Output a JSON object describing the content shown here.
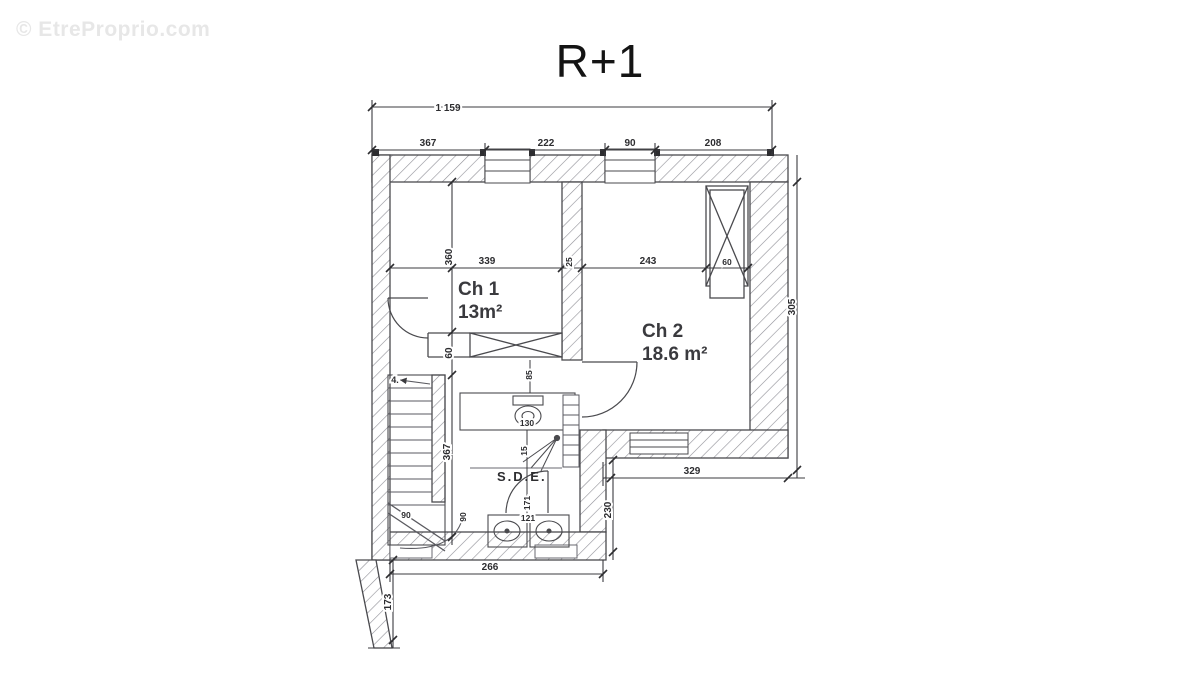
{
  "watermark": "© EtreProprio.com",
  "title": "R+1",
  "rooms": {
    "ch1_name": "Ch 1",
    "ch1_area": "13m²",
    "ch2_name": "Ch 2",
    "ch2_area": "18.6 m²",
    "sde_name": "S.D.E."
  },
  "stairs": {
    "count_label": "4."
  },
  "dims": {
    "total_width": "1 159",
    "top_seg_left": "367",
    "top_seg_win1": "222",
    "top_seg_win2": "90",
    "top_seg_right": "208",
    "ch1_width": "339",
    "wall_thickness": "25",
    "ch2_width": "243",
    "duct_width": "60",
    "ch1_depth": "360",
    "hall_height": "60",
    "stair_height": "367",
    "stair_width": "90",
    "hall_width": "90",
    "right_height": "305",
    "ch2_bottom_width": "329",
    "sde_right_height": "230",
    "bottom_width": "266",
    "left_ext_height": "173",
    "wc_width": "130",
    "wc_side": "85",
    "shower_dim": "15",
    "sde_door_dim": "171",
    "sde_width": "121"
  }
}
